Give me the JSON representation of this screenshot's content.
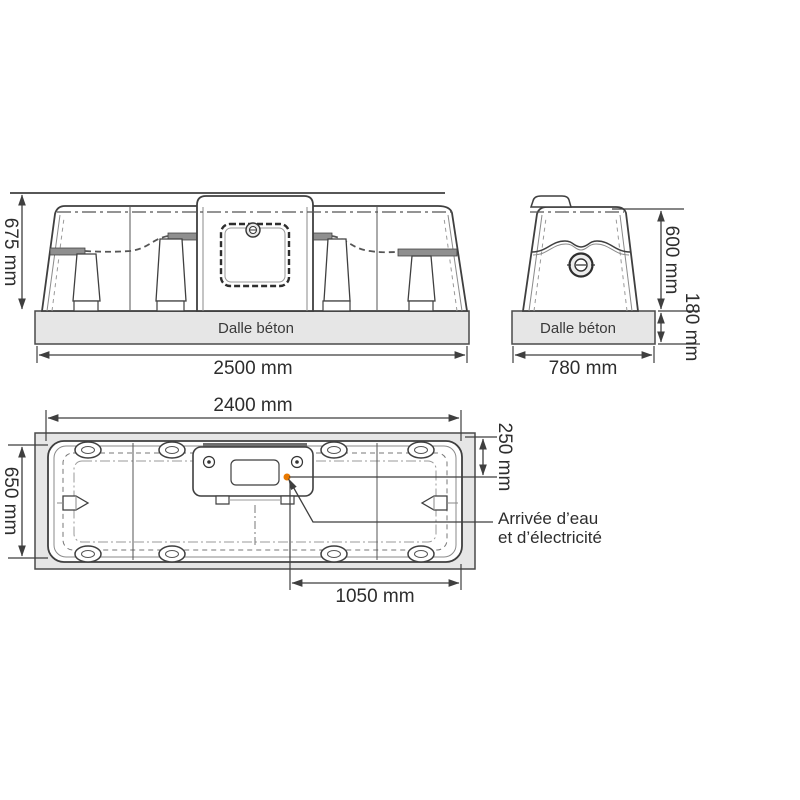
{
  "colors": {
    "line": "#3f3f3f",
    "slab_fill": "#e6e6e6",
    "accent_orange": "#e87800",
    "text": "#2d2d2d"
  },
  "front_view": {
    "height_dim": "675 mm",
    "width_dim": "2500 mm",
    "slab_label": "Dalle béton"
  },
  "side_view": {
    "width_dim": "780 mm",
    "height_dim": "600 mm",
    "slab_height_dim": "180 mm",
    "slab_label": "Dalle béton"
  },
  "plan_view": {
    "length_dim": "2400 mm",
    "depth_dim": "650 mm",
    "inlet_offset_dim": "250 mm",
    "inlet_position_dim": "1050 mm",
    "inlet_label_line1": "Arrivée d’eau",
    "inlet_label_line2": "et d’électricité"
  }
}
